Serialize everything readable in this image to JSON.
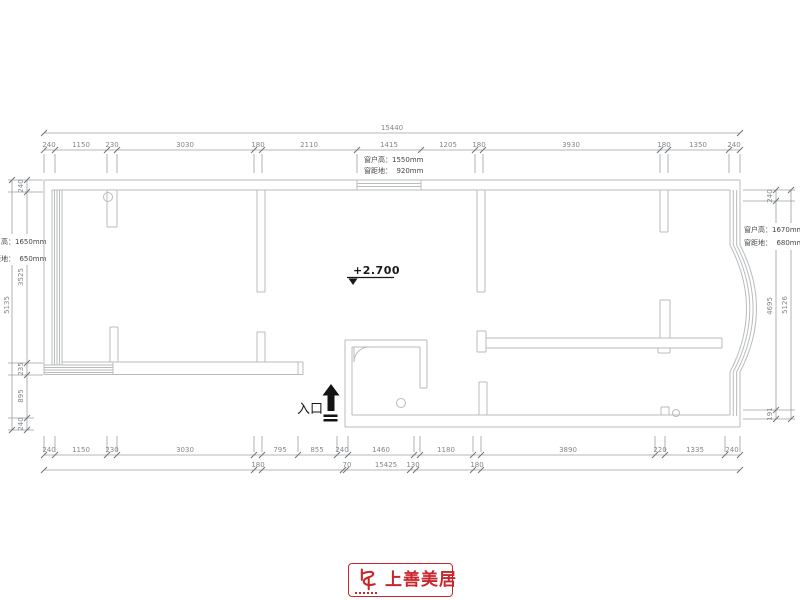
{
  "annotations": {
    "elevation": "+2.700",
    "entrance": "入口",
    "window_top": {
      "l1": "窗户高：1550mm",
      "l2": "窗距地：  920mm"
    },
    "window_left": {
      "l1": "窗户高：1650mm",
      "l2": "窗距地：  650mm"
    },
    "window_right": {
      "l1": "窗户高：1670mm",
      "l2": "窗距地：  680mm"
    }
  },
  "dims": {
    "top_overall": "15440",
    "top": [
      "240",
      "1150",
      "230",
      "3030",
      "180",
      "2110",
      "1415",
      "1205",
      "180",
      "3930",
      "180",
      "1350",
      "240"
    ],
    "bottom": [
      "240",
      "1150",
      "230",
      "3030",
      "795",
      "855",
      "240",
      "1460",
      "1180",
      "3890",
      "220",
      "1335",
      "240"
    ],
    "bottom_sub": [
      "180",
      "70",
      "15425",
      "130",
      "180"
    ],
    "left": [
      "240",
      "3525",
      "235",
      "895",
      "240"
    ],
    "left_overall": "5135",
    "right": [
      "240",
      "4695",
      "191"
    ],
    "right_overall": "5126"
  },
  "logo": {
    "name": "上善美居"
  }
}
